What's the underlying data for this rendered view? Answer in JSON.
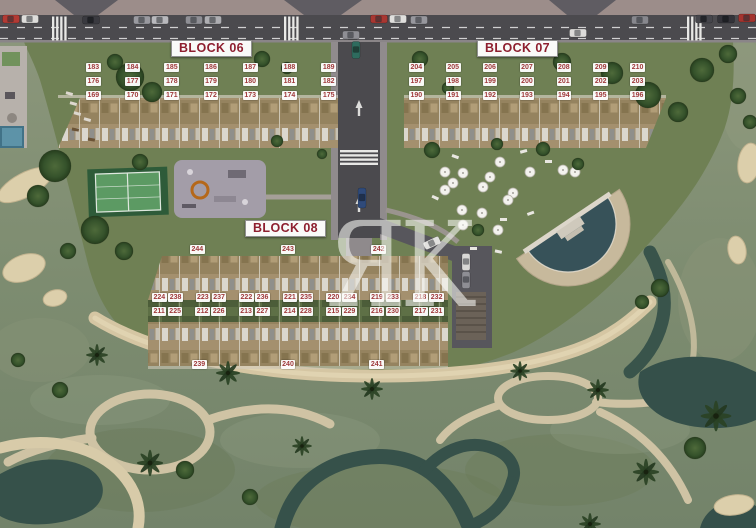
{
  "page": {
    "type": "residential-site-plan-aerial"
  },
  "blocks": {
    "block06": {
      "label": "BLOCK 06",
      "rows": [
        [
          "183",
          "184",
          "185",
          "186",
          "187",
          "188",
          "189"
        ],
        [
          "176",
          "177",
          "178",
          "179",
          "180",
          "181",
          "182"
        ],
        [
          "169",
          "170",
          "171",
          "172",
          "173",
          "174",
          "175"
        ]
      ]
    },
    "block07": {
      "label": "BLOCK 07",
      "rows": [
        [
          "204",
          "205",
          "206",
          "207",
          "208",
          "209",
          "210"
        ],
        [
          "197",
          "198",
          "199",
          "200",
          "201",
          "202",
          "203"
        ],
        [
          "190",
          "191",
          "192",
          "193",
          "194",
          "195",
          "196"
        ]
      ]
    },
    "block08": {
      "label": "BLOCK 08",
      "top_row": [
        "244",
        "243",
        "242"
      ],
      "row_a": [
        [
          "224",
          "238"
        ],
        [
          "223",
          "237"
        ],
        [
          "222",
          "236"
        ],
        [
          "221",
          "235"
        ],
        [
          "220",
          "234"
        ],
        [
          "219",
          "233"
        ],
        [
          "218",
          "232"
        ]
      ],
      "row_b": [
        [
          "211",
          "225"
        ],
        [
          "212",
          "226"
        ],
        [
          "213",
          "227"
        ],
        [
          "214",
          "228"
        ],
        [
          "215",
          "229"
        ],
        [
          "216",
          "230"
        ],
        [
          "217",
          "231"
        ]
      ],
      "bottom_row": [
        "239",
        "240",
        "241"
      ]
    }
  },
  "watermark": {
    "text": "ЯK"
  },
  "features": {
    "icons": [
      "tennis-court",
      "playground",
      "swimming-pool",
      "parasol",
      "palm-tree",
      "car",
      "crosswalk",
      "golf-bunker",
      "water-stream",
      "sand-beach"
    ]
  },
  "colors": {
    "unit_label_red": "#a03a3c",
    "block_label_red": "#8e1f2f",
    "road_gray": "#4b4a4e",
    "top_band_mauve": "#9c8d8a",
    "lawn_green": "#6f7f55",
    "golf_green": "#7e8c6f",
    "water_teal": "#39544b",
    "sand": "#d8cba9",
    "building_tan": "#a4906e",
    "pool_water": "#375259",
    "watermark_white": "rgba(250,250,247,0.58)"
  }
}
